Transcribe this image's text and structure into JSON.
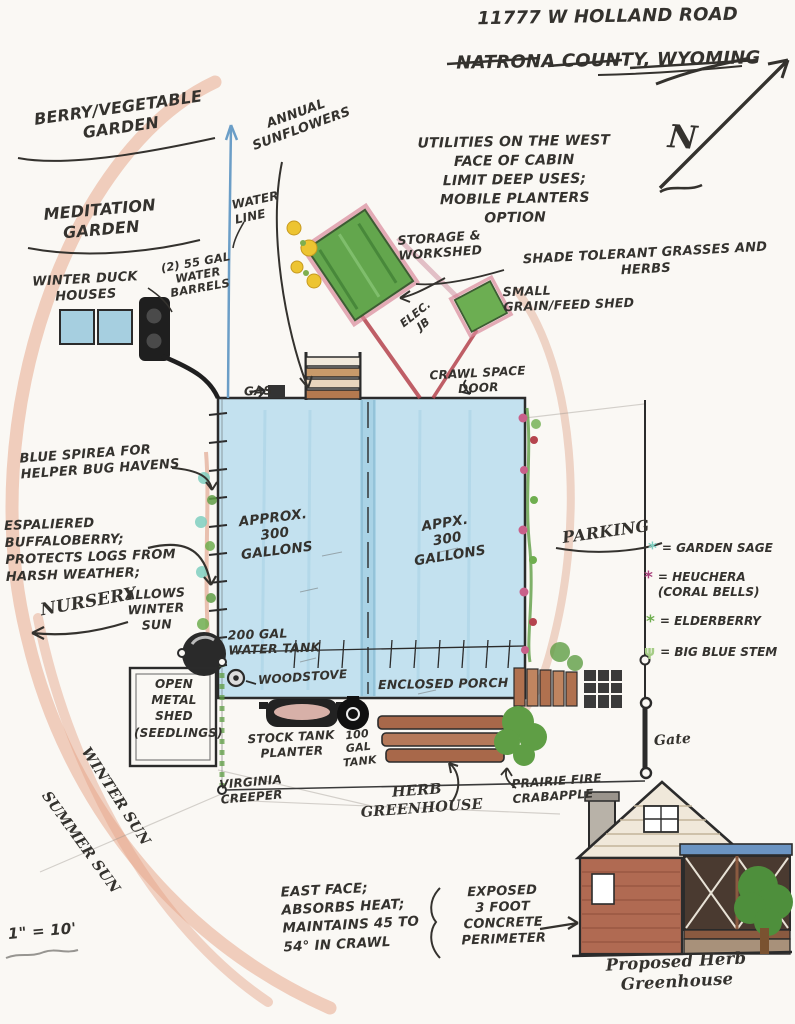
{
  "title": {
    "address_line1": "11777 W HOLLAND ROAD",
    "address_line2": "NATRONA COUNTY, WYOMING"
  },
  "compass": {
    "north": "N"
  },
  "scale_note": "1\" = 10'",
  "labels": {
    "berry_garden": "BERRY/VEGETABLE\nGARDEN",
    "meditation_garden": "MEDITATION\nGARDEN",
    "winter_duck_houses": "WINTER DUCK\nHOUSES",
    "water_barrels": "(2) 55 GAL\nWATER\nBARRELS",
    "annual_sunflowers": "ANNUAL\nSUNFLOWERS",
    "water_line": "WATER\nLINE",
    "utilities_note": "UTILITIES ON THE WEST\nFACE OF CABIN\nLIMIT DEEP USES;\nMOBILE PLANTERS\nOPTION",
    "storage_workshed": "STORAGE &\nWORKSHED",
    "shade_tolerant": "SHADE TOLERANT GRASSES AND\nHERBS",
    "small_grain_shed": "SMALL\nGRAIN/FEED SHED",
    "elec_jb": "ELEC.\nJB",
    "crawl_space_door": "CRAWL SPACE\nDOOR",
    "gas": "GAS",
    "blue_spirea": "BLUE SPIREA FOR\nHELPER BUG HAVENS",
    "espaliered": "ESPALIERED\nBUFFALOBERRY;\nPROTECTS LOGS FROM\nHARSH WEATHER;",
    "allows_winter_sun": "ALLOWS\nWINTER\nSUN",
    "nursery": "NURSERY",
    "gallons_left": "APPROX.\n300\nGALLONS",
    "gallons_right": "APPX.\n300\nGALLONS",
    "parking": "PARKING",
    "tank_200": "200 GAL\nWATER TANK",
    "woodstove": "WOODSTOVE",
    "enclosed_porch": "ENCLOSED PORCH",
    "open_metal_shed": "OPEN\nMETAL\nSHED\n(SEEDLINGS)",
    "stock_tank": "STOCK TANK\nPLANTER",
    "tank_100": "100\nGAL\nTANK",
    "virginia_creeper": "VIRGINIA\nCREEPER",
    "herb_greenhouse": "HERB\nGREENHOUSE",
    "prairie_fire": "PRAIRIE FIRE\nCRABAPPLE",
    "winter_sun": "WINTER SUN",
    "summer_sun": "SUMMER SUN",
    "east_face": "EAST FACE;\nABSORBS HEAT;\nMAINTAINS 45 TO\n54° IN CRAWL",
    "exposed_concrete": "EXPOSED\n3 FOOT\nCONCRETE\nPERIMETER",
    "proposed_greenhouse": "Proposed Herb\nGreenhouse",
    "gate": "Gate"
  },
  "legend": {
    "items": [
      {
        "symbol_name": "asterisk-icon",
        "glyph": "*",
        "color": "#7fcfc0",
        "label": "= GARDEN SAGE"
      },
      {
        "symbol_name": "asterisk-icon",
        "glyph": "*",
        "color": "#a8437c",
        "label": "= HEUCHERA\n(CORAL BELLS)"
      },
      {
        "symbol_name": "asterisk-icon",
        "glyph": "*",
        "color": "#6fae4f",
        "label": "= ELDERBERRY"
      },
      {
        "symbol_name": "grass-sprig-icon",
        "glyph": "ψ",
        "color": "#a5cd86",
        "label": "= BIG BLUE STEM"
      }
    ]
  },
  "colors": {
    "sun_arc": "#e5a284",
    "cabin_roof": "#c3e1ef",
    "shed_green": "#63a64d",
    "electric_red": "#b5444e",
    "water_blue": "#6b9ec7",
    "ink": "#34322e"
  }
}
